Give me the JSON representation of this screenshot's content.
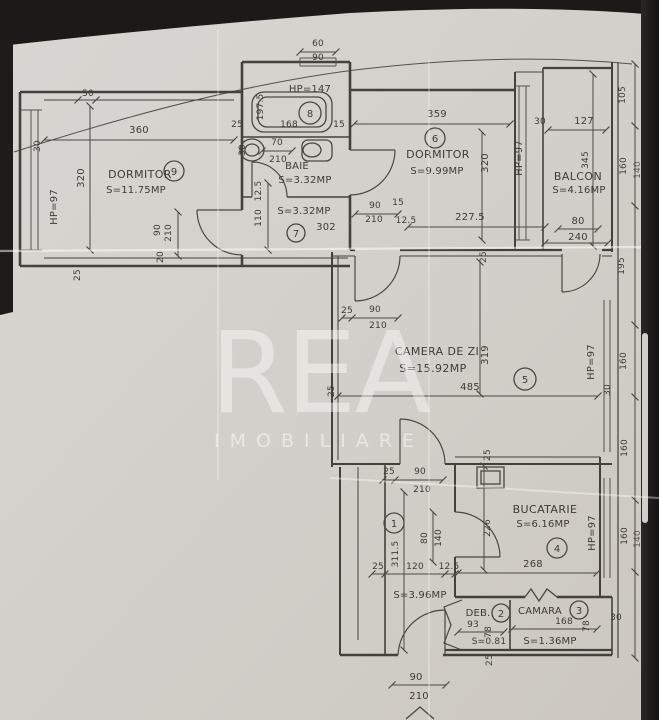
{
  "watermark": {
    "line1": "REA",
    "line2": "IMOBILIARE"
  },
  "colors": {
    "paper": "#d3d0cb",
    "ink": "#3e3b37",
    "background": "#1b1a18",
    "crease": "#ffffff"
  },
  "rooms": {
    "dormitor9": {
      "num": "9",
      "name": "DORMITOR",
      "area": "S=11.75MP"
    },
    "camera8": {
      "num": "8",
      "hp": "HP=147"
    },
    "baie": {
      "name": "BAIE",
      "area": "S=3.32MP"
    },
    "hol7": {
      "num": "7",
      "area": "S=3.32MP",
      "length": "302"
    },
    "dormitor6": {
      "num": "6",
      "name": "DORMITOR",
      "area": "S=9.99MP"
    },
    "balcon": {
      "name": "BALCON",
      "area": "S=4.16MP"
    },
    "camerazi": {
      "num": "5",
      "name": "CAMERA DE ZI",
      "area": "S=15.92MP"
    },
    "hol1": {
      "num": "1",
      "area": "S=3.96MP"
    },
    "bucatarie": {
      "num": "4",
      "name": "BUCATARIE",
      "area": "S=6.16MP"
    },
    "deb": {
      "num": "2",
      "name": "DEB.",
      "area": "S=0.81"
    },
    "camara": {
      "num": "3",
      "name": "CAMARA",
      "area": "S=1.36MP"
    }
  },
  "dims": {
    "d9_50": "50",
    "d9_30": "30",
    "d9_w": "360",
    "d9_h": "320",
    "d9_hp": "HP=97",
    "d9_door_w": "90",
    "d9_door_h": "210",
    "d9_25a": "25",
    "d9_20": "20",
    "d9_25b": "25",
    "b8_60": "60",
    "b8_90": "90",
    "b8_l": "197.5",
    "b8_168": "168",
    "b8_15": "15",
    "ba_30": "30",
    "ba_70": "70",
    "ba_210": "210",
    "h7_125a": "12.5",
    "h7_110": "110",
    "h7_90": "90",
    "h7_210": "210",
    "h7_15": "15",
    "h7_125b": "12.5",
    "d6_w": "359",
    "d6_h": "320",
    "d6_hp": "HP=97",
    "d6_227": "227.5",
    "d6_25": "25",
    "bal_30": "30",
    "bal_127": "127",
    "bal_345": "345",
    "bal_80": "80",
    "bal_240": "240",
    "r_105": "105",
    "r_160a": "160",
    "r_140a": "140",
    "r_195": "195",
    "r_160b": "160",
    "r_30": "30",
    "r_160c": "160",
    "r_160d": "160",
    "r_140b": "140",
    "lr_25a": "25",
    "lr_90": "90",
    "lr_210": "210",
    "lr_319": "319",
    "lr_485": "485",
    "lr_25b": "25",
    "lr_hp": "HP=97",
    "k_25": "25",
    "k_226": "226",
    "k_268": "268",
    "k_hp": "HP=97",
    "h1_25a": "25",
    "h1_90": "90",
    "h1_210": "210",
    "h1_80": "80",
    "h1_140": "140",
    "h1_len": "311.5",
    "h1_25b": "25",
    "h1_120": "120",
    "h1_125": "12.5",
    "deb_93": "93",
    "deb_78": "78",
    "cam_168": "168",
    "cam_78": "78",
    "cam_30": "30",
    "cam_25": "25",
    "ent_90": "90",
    "ent_210": "210"
  }
}
